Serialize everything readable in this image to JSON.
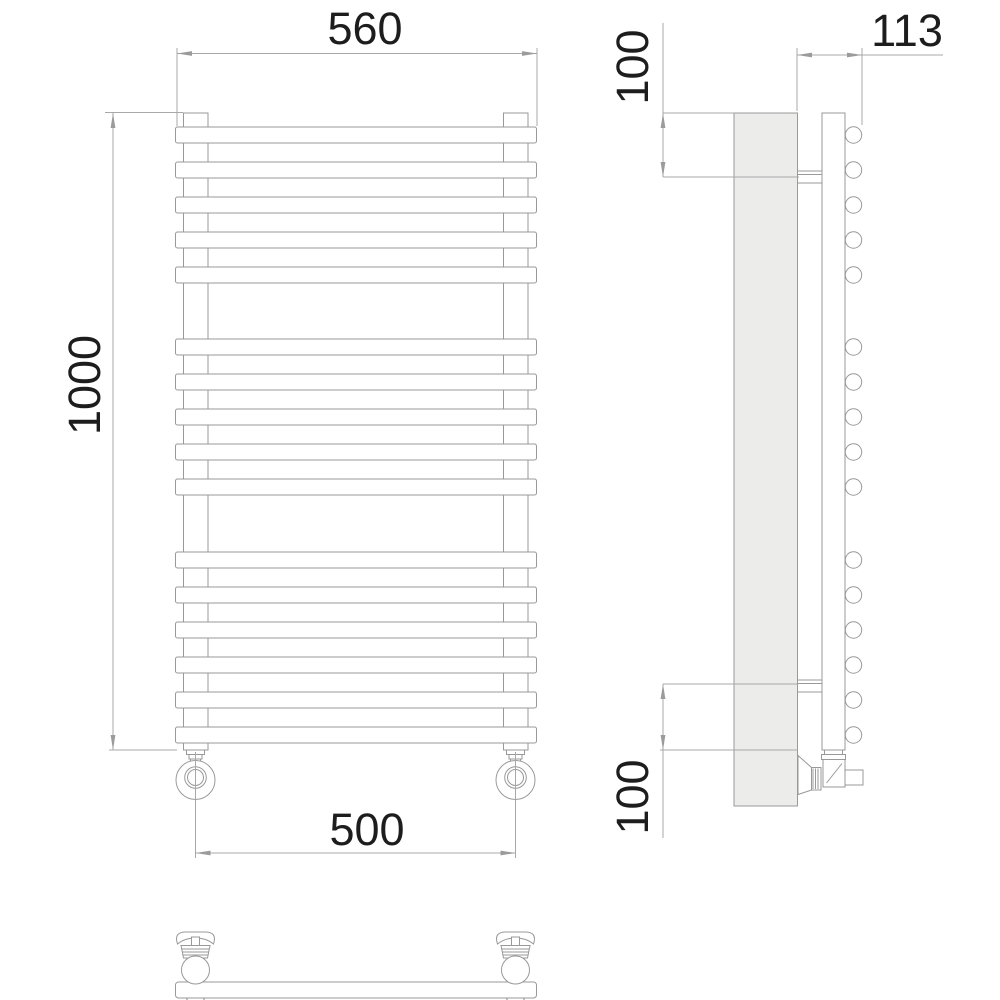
{
  "drawing": {
    "type": "towel-radiator-technical-drawing",
    "colors": {
      "background": "#ffffff",
      "object_line": "#999999",
      "dimension_line": "#a8a8a8",
      "text": "#1d1d1d",
      "panel_fill": "#ececeb"
    },
    "views": {
      "front": {
        "dim_overall_width": "560",
        "dim_overall_height": "1000",
        "dim_valve_spacing": "500",
        "bar_count": 16
      },
      "side": {
        "dim_depth": "113",
        "dim_top_bracket_offset": "100",
        "dim_bottom_bracket_offset": "100"
      }
    }
  }
}
